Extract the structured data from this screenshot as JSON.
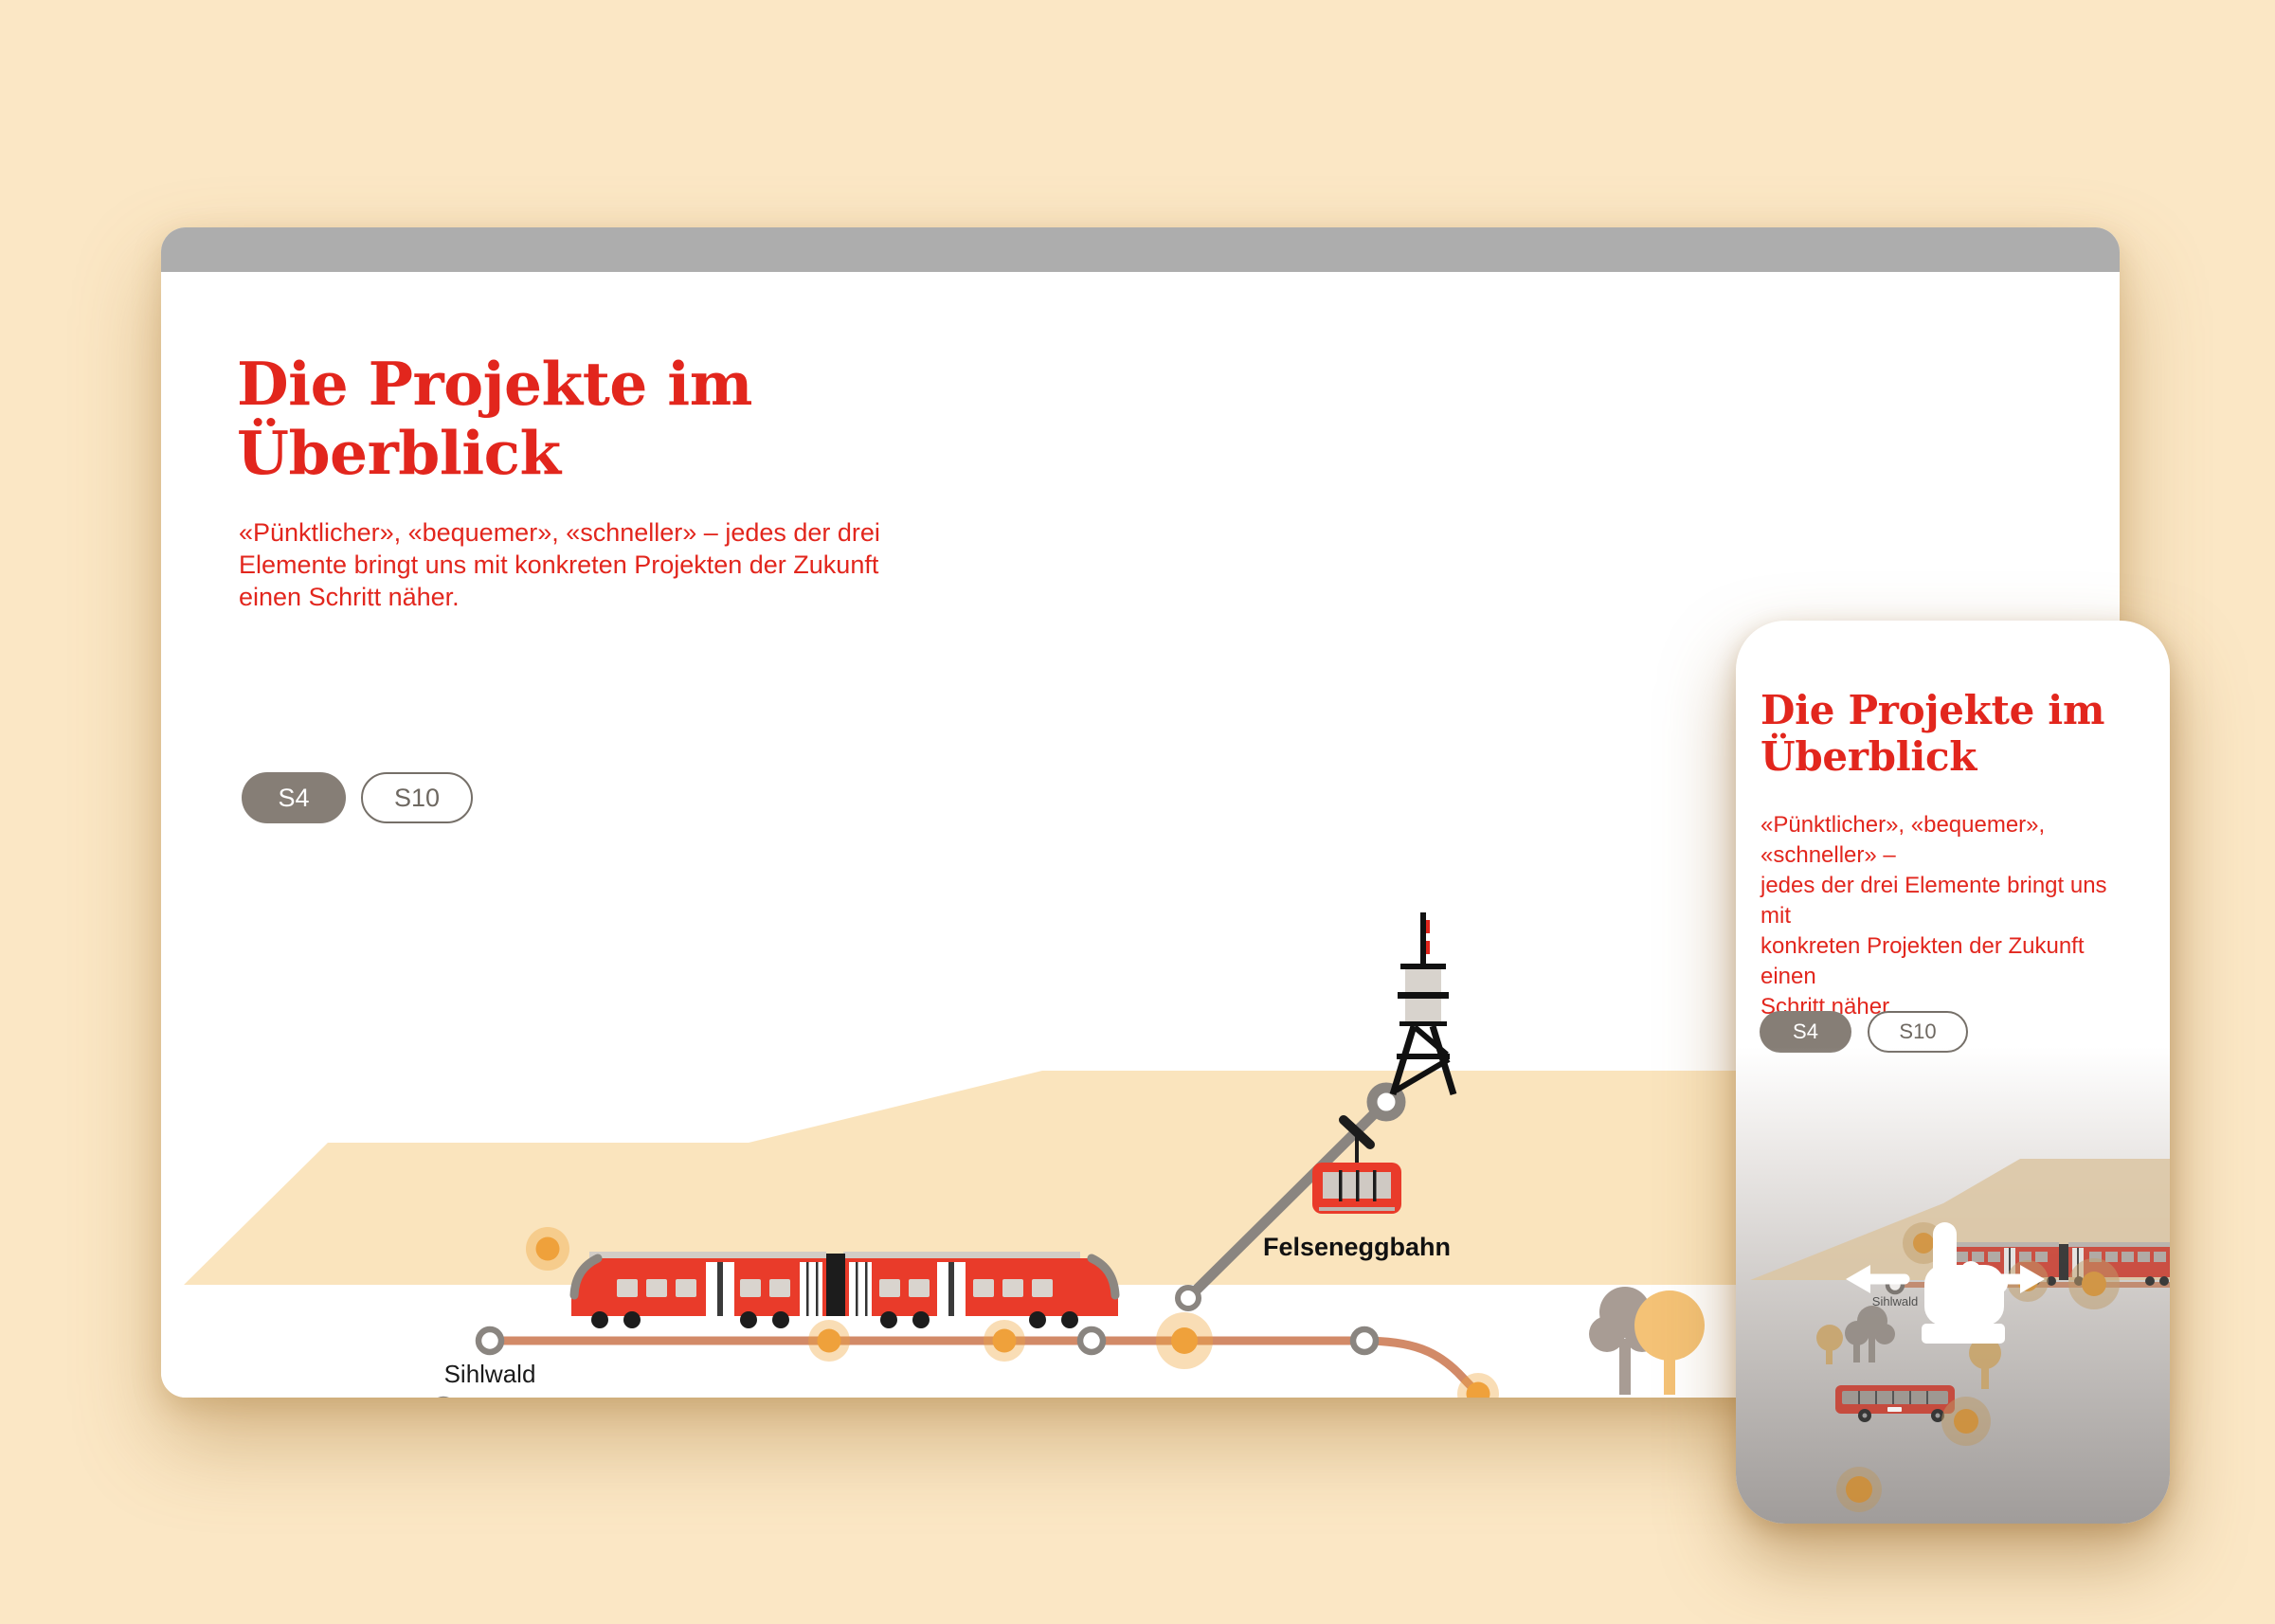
{
  "desktop": {
    "title": "Die Projekte im\nÜberblick",
    "intro": "«Pünktlicher», «bequemer», «schneller» – jedes der drei\nElemente bringt uns mit konkreten Projekten der Zukunft\neinen Schritt näher.",
    "toggles": [
      {
        "label": "S4",
        "active": true
      },
      {
        "label": "S10",
        "active": false
      }
    ],
    "map": {
      "station_label": "Sihlwald",
      "cablecar_label": "Felseneggbahn"
    }
  },
  "mobile": {
    "title": "Die Projekte im\nÜberblick",
    "intro": "«Pünktlicher», «bequemer», «schneller» –\njedes der drei Elemente bringt uns mit\nkonkreten Projekten der Zukunft einen\nSchritt näher.",
    "toggles": [
      {
        "label": "S4",
        "active": true
      },
      {
        "label": "S10",
        "active": false
      }
    ],
    "map": {
      "station_label": "Sihlwald"
    }
  },
  "colors": {
    "brand_red": "#E2261D",
    "train_red": "#E93B2A",
    "accent_orange": "#EFA13B",
    "line_salmon": "#D28A68",
    "ui_gray": "#867E76",
    "browser_bar_gray": "#ADADAD",
    "hill_peach": "#FAE4BD",
    "background_peach": "#FBE7C5"
  }
}
